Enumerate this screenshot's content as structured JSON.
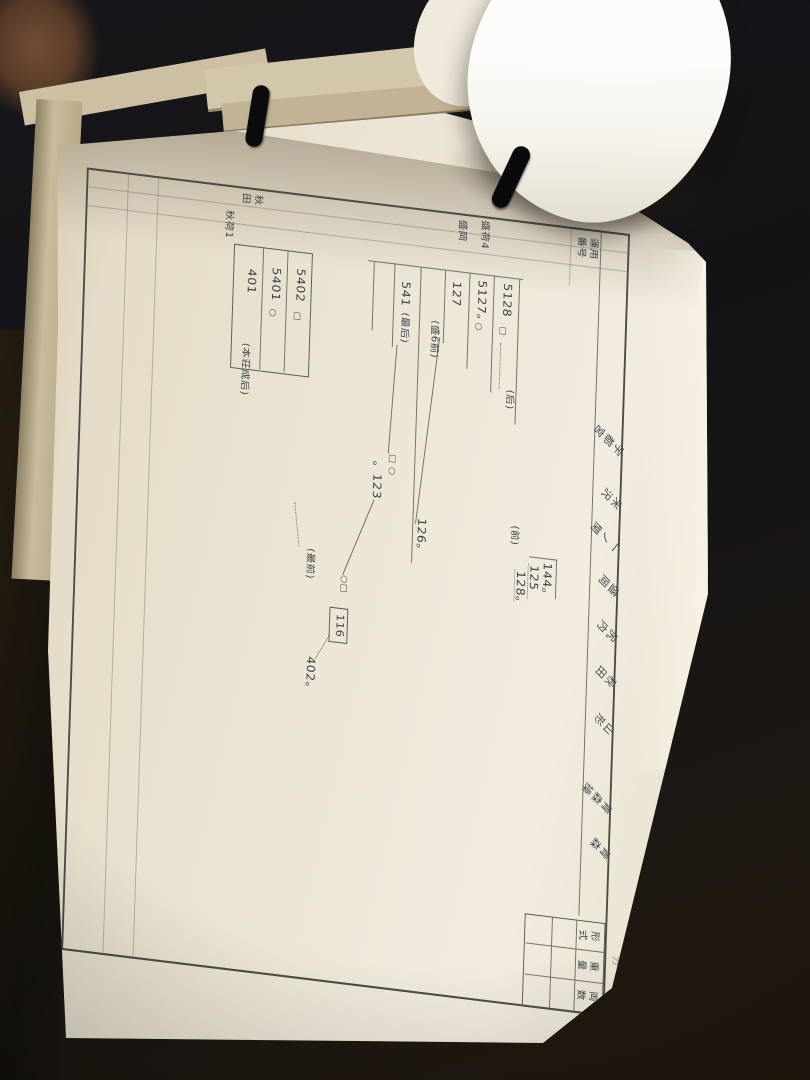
{
  "scene": {
    "description": "Photograph of an open vintage Japanese railway carriage working-diagram book; the page is rotated 90 degrees clockwise in the photo",
    "bookmarks": [
      "black-cord-left",
      "black-cord-right"
    ]
  },
  "diagram": {
    "corner_label_line1": "運用",
    "corner_label_line2": "番号",
    "stations": [
      {
        "name": "宇都宮"
      },
      {
        "name": "米沢"
      },
      {
        "name": "一ノ関"
      },
      {
        "name": "盛岡"
      },
      {
        "name": "尻内"
      },
      {
        "name": "秋田"
      },
      {
        "name": "山形"
      },
      {
        "name": "青森操"
      },
      {
        "name": "青森"
      }
    ],
    "column_headers": [
      {
        "label": "形式"
      },
      {
        "label": "重量"
      },
      {
        "label": "両数"
      }
    ],
    "margin_mark": "カ",
    "duties": [
      {
        "duty": "盛荷4",
        "depot": "盛岡"
      },
      {
        "duty": "秋荷1",
        "depot": "秋田"
      }
    ],
    "el": {
      "n5128": "5128",
      "m5128": "□",
      "a_ushiro": "(后)",
      "n5127": "5127。",
      "m5127": "○",
      "n127": "127",
      "a_mori6": "(盛6前)",
      "n126": "126。",
      "n541": "541",
      "a_saigo": "(最后)",
      "m_sqcirc": "□ ○",
      "n123": "。123",
      "a_mae": "(前)",
      "n144": "144。",
      "n125": "125",
      "n128": "128。",
      "m_circsq": "○□",
      "n116": "116",
      "n402": "402。",
      "a_saizen": "(最前)",
      "n5402": "5402",
      "m5402": "□",
      "n5401": "5401",
      "m5401": "○",
      "n401": "401",
      "a_honjo": "(本荘成后)"
    }
  }
}
